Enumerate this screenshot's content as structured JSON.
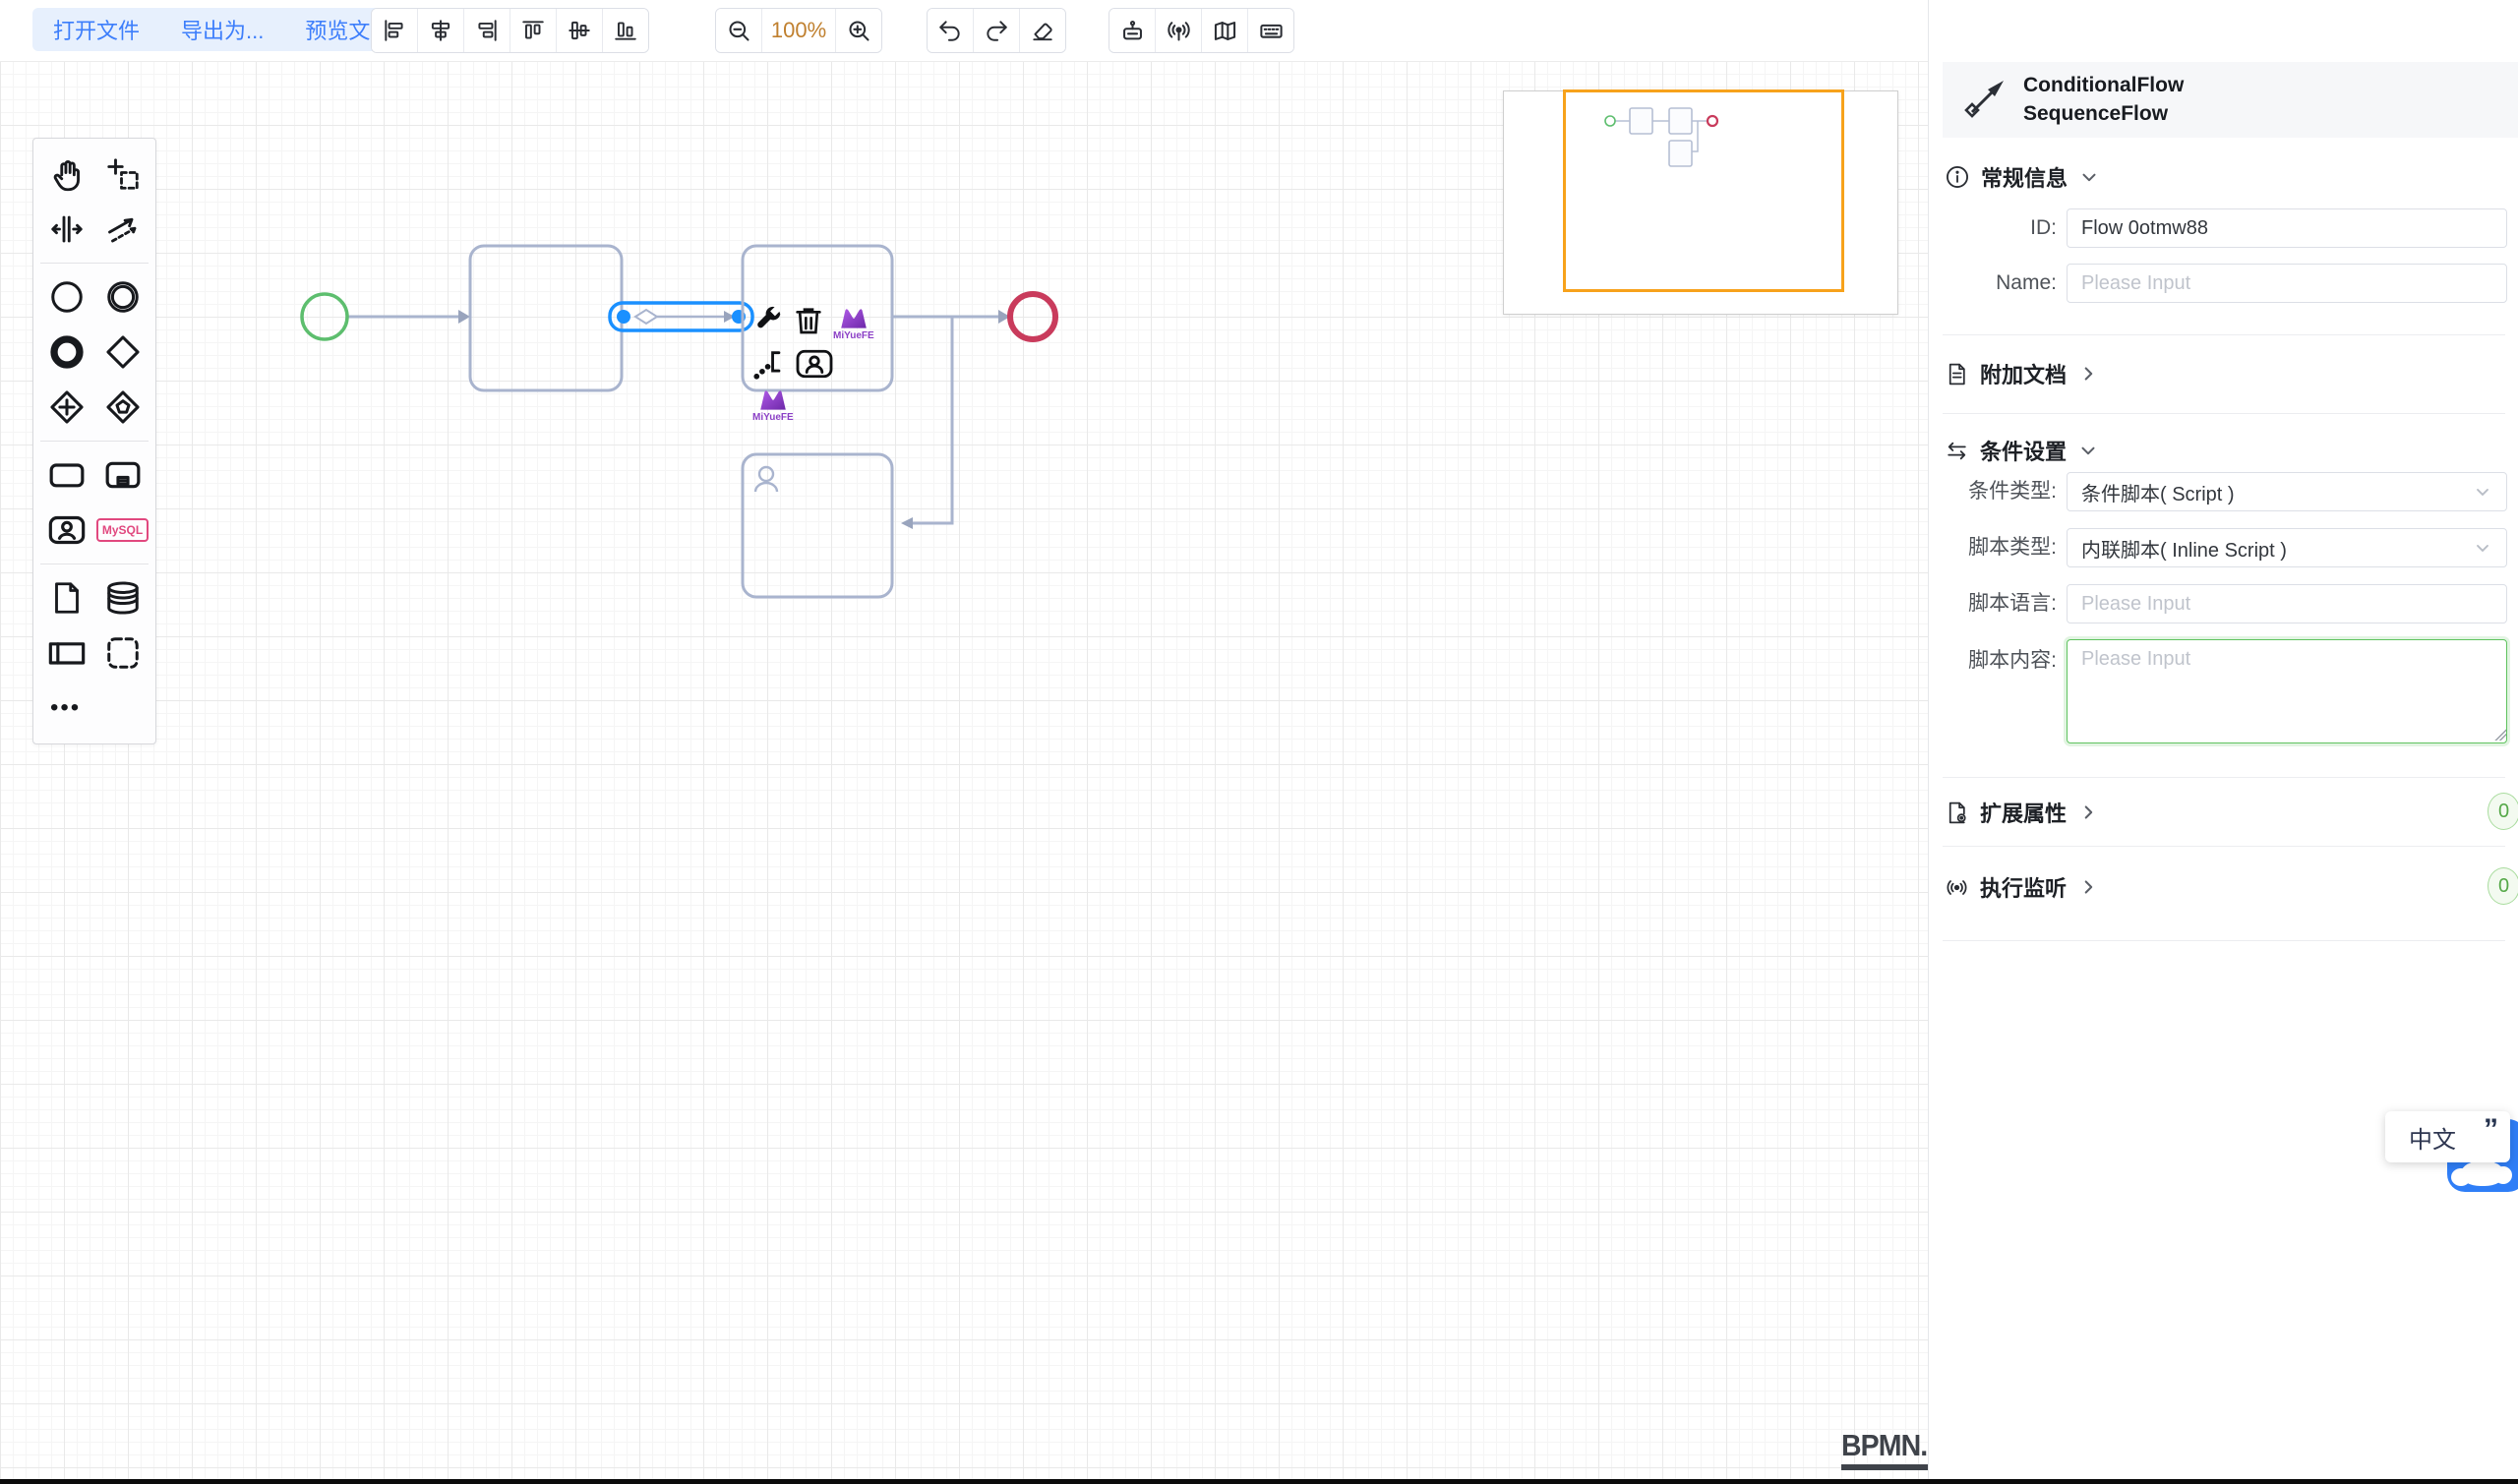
{
  "toolbar": {
    "file_buttons": [
      "打开文件",
      "导出为...",
      "预览文件"
    ],
    "zoom_level": "100%",
    "icons": [
      "align-left-icon",
      "align-horizontal-center-icon",
      "align-right-icon",
      "align-top-icon",
      "align-vertical-middle-icon",
      "align-bottom-icon",
      "zoom-out-icon",
      "zoom-in-icon",
      "undo-icon",
      "redo-icon",
      "eraser-icon",
      "simulation-robot-icon",
      "process-listener-icon",
      "minimap-toggle-icon",
      "keyboard-shortcuts-icon"
    ]
  },
  "palette": {
    "mysql_label": "MySQL",
    "more_label": "•••",
    "icons": [
      "hand-tool-icon",
      "lasso-tool-icon",
      "space-tool-icon",
      "global-connect-icon",
      "start-event-icon",
      "intermediate-event-icon",
      "end-event-icon",
      "exclusive-gateway-icon",
      "parallel-gateway-icon",
      "complex-gateway-icon",
      "task-icon",
      "subprocess-icon",
      "user-task-icon",
      "mysql-task-icon",
      "data-object-icon",
      "data-store-icon",
      "participant-icon",
      "group-icon",
      "more-icon"
    ]
  },
  "context_pad": {
    "logo_caption": "MiYueFE",
    "icons": [
      "wrench-icon",
      "trash-icon",
      "miyuefe-logo-icon",
      "text-annotation-icon",
      "append-user-task-icon"
    ]
  },
  "canvas": {
    "logo": "BPMN.iO",
    "elements": [
      "start-event",
      "task",
      "conditional-sequence-flow-selected",
      "task-with-context-pad",
      "end-event",
      "user-task"
    ]
  },
  "properties_panel": {
    "header": {
      "type_line1": "ConditionalFlow",
      "type_line2": "SequenceFlow"
    },
    "general": {
      "title": "常规信息",
      "id_label": "ID:",
      "id_value": "Flow 0otmw88",
      "name_label": "Name:",
      "name_placeholder": "Please Input"
    },
    "docs": {
      "title": "附加文档"
    },
    "condition": {
      "title": "条件设置",
      "type_label": "条件类型:",
      "type_value": "条件脚本( Script )",
      "script_type_label": "脚本类型:",
      "script_type_value": "内联脚本( Inline Script )",
      "script_lang_label": "脚本语言:",
      "script_lang_placeholder": "Please Input",
      "script_body_label": "脚本内容:",
      "script_body_placeholder": "Please Input"
    },
    "ext_props": {
      "title": "扩展属性",
      "count": "0"
    },
    "exec_listener": {
      "title": "执行监听",
      "count": "0"
    }
  },
  "widgets": {
    "language": "中文",
    "quote_mark": "”"
  },
  "colors": {
    "accent_blue": "#3d7efb",
    "selection_blue": "#1a90ff",
    "shape_stroke": "#a9b4ce",
    "start_event_green": "#5dbe6e",
    "end_event_red": "#c93b5c",
    "focus_green": "#5fc35f",
    "badge_green": "#55a848",
    "minimap_viewport_orange": "#f7a21b",
    "zoom_level_orange": "#c0802f",
    "logo_purple": "#8b3fc6"
  }
}
